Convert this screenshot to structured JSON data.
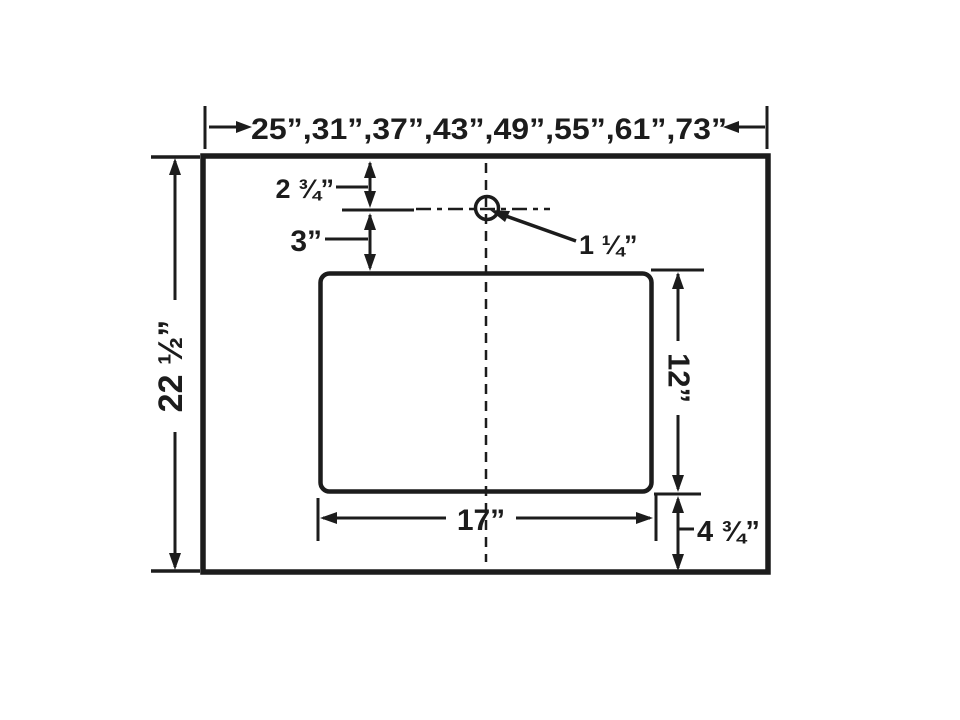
{
  "diagram": {
    "colors": {
      "line": "#1c1c1c",
      "background": "#ffffff"
    },
    "dimensions": {
      "width_options": "25”,31”,37”,43”,49”,55”,61”,73”",
      "overall_depth": "22 ½”",
      "faucet_center_from_top": "2 ¾”",
      "faucet_center_to_cutout": "3”",
      "faucet_hole_diameter": "1 ¼”",
      "cutout_depth": "12”",
      "cutout_width": "17”",
      "cutout_to_front_edge": "4 ¾”"
    }
  }
}
